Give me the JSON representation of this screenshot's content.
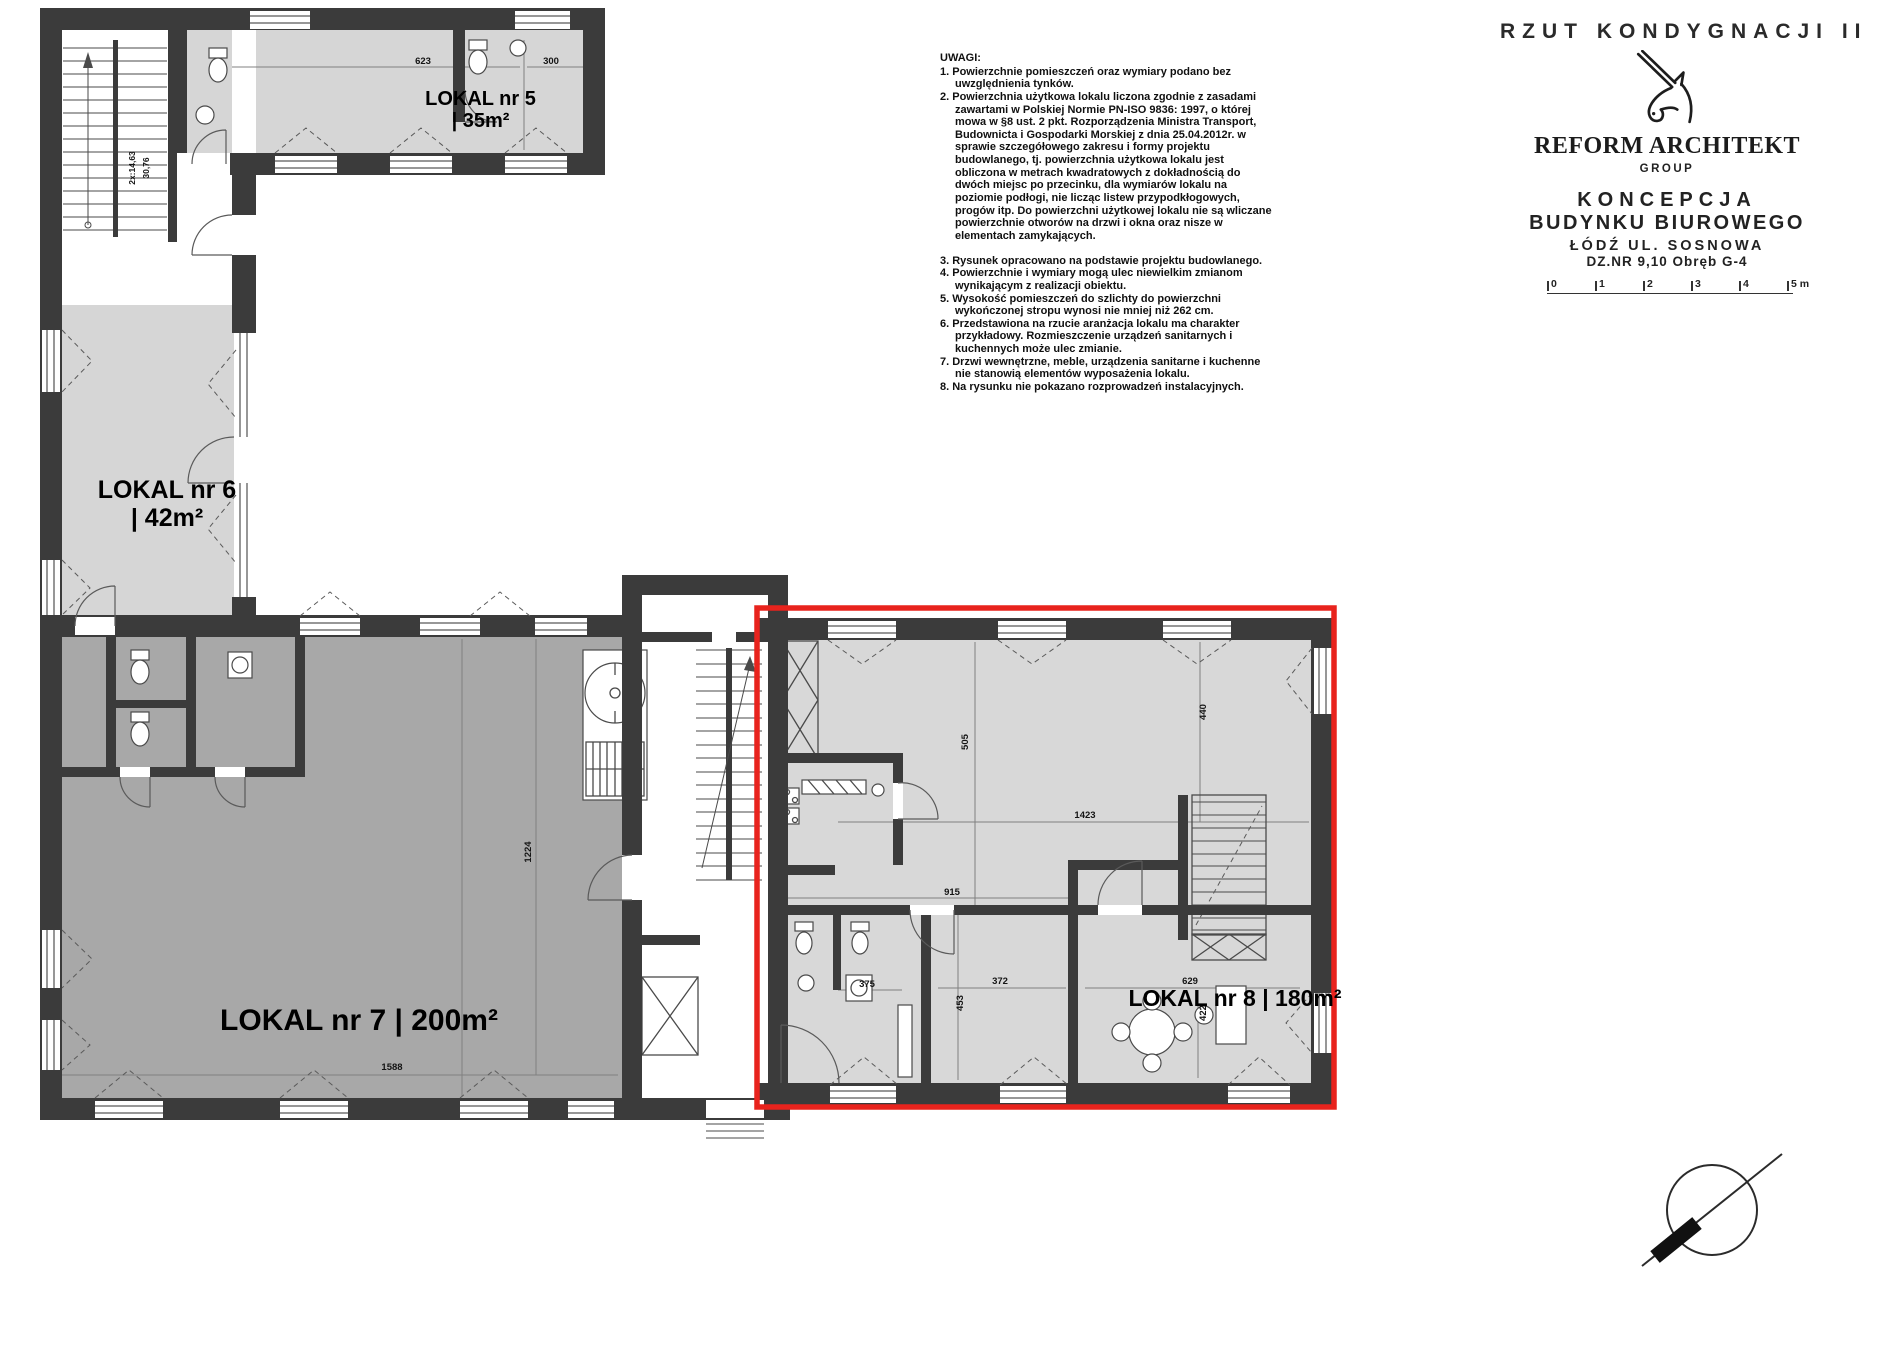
{
  "title_block": {
    "drawing_title": "RZUT KONDYGNACJI II",
    "firm_name": "REFORM ARCHITEKT",
    "firm_sub": "GROUP",
    "project_line1": "KONCEPCJA",
    "project_line2": "BUDYNKU BIUROWEGO",
    "address_line1": "ŁÓDŹ UL. SOSNOWA",
    "address_line2": "DZ.NR 9,10 Obręb G-4",
    "scale": [
      "0",
      "1",
      "2",
      "3",
      "4",
      "5 m"
    ]
  },
  "notes": {
    "heading": "UWAGI:",
    "items": [
      "1. Powierzchnie pomieszczeń oraz wymiary podano bez uwzględnienia tynków.",
      "2. Powierzchnia użytkowa lokalu liczona zgodnie z zasadami zawartami w Polskiej Normie PN-ISO 9836: 1997, o której mowa w §8 ust. 2 pkt. Rozporządzenia Ministra Transport, Budownicta i Gospodarki Morskiej z dnia 25.04.2012r. w sprawie szczegółowego zakresu i formy projektu budowlanego, tj. powierzchnia użytkowa lokalu jest obliczona w metrach kwadratowych z dokładnością do dwóch miejsc po przecinku, dla wymiarów lokalu na poziomie podłogi, nie licząc listew przypodkłogowych, progów itp. Do powierzchni użytkowej lokalu nie są wliczane powierzchnie otworów na drzwi i okna oraz nisze w elementach zamykających.",
      "3. Rysunek opracowano na podstawie projektu budowlanego.",
      "4. Powierzchnie i wymiary mogą ulec niewielkim zmianom wynikającym z realizacji obiektu.",
      "5. Wysokość pomieszczeń do szlichty do powierzchni wykończonej stropu wynosi nie mniej niż 262 cm.",
      "6. Przedstawiona na rzucie aranżacja lokalu ma charakter przykładowy. Rozmieszczenie urządzeń sanitarnych i kuchennych może ulec zmianie.",
      "7. Drzwi wewnętrzne, meble, urządzenia sanitarne i kuchenne nie stanowią elementów wyposażenia lokalu.",
      "8. Na rysunku nie pokazano rozprowadzeń instalacyjnych."
    ]
  },
  "units": {
    "lokal5": {
      "name": "LOKAL nr 5",
      "area": "| 35m²"
    },
    "lokal6": {
      "name": "LOKAL nr 6",
      "area": "| 42m²"
    },
    "lokal7": {
      "label": "LOKAL nr 7 | 200m²"
    },
    "lokal8": {
      "label": "LOKAL nr 8 | 180m²",
      "highlighted": true
    }
  },
  "dims": {
    "d623": "623",
    "d300": "300",
    "d1423": "1423",
    "d440": "440",
    "d505": "505",
    "d915": "915",
    "d375": "375",
    "d372": "372",
    "d453": "453",
    "d629": "629",
    "d422": "422",
    "d1224": "1224",
    "d1588": "1588",
    "stair_a": "2x:14,63",
    "stair_b": "30,76"
  },
  "colors": {
    "highlight_red": "#e8231d",
    "wall": "#3b3b3b",
    "room_light": "#d8d8d8",
    "room_dark": "#a8a8a8"
  }
}
